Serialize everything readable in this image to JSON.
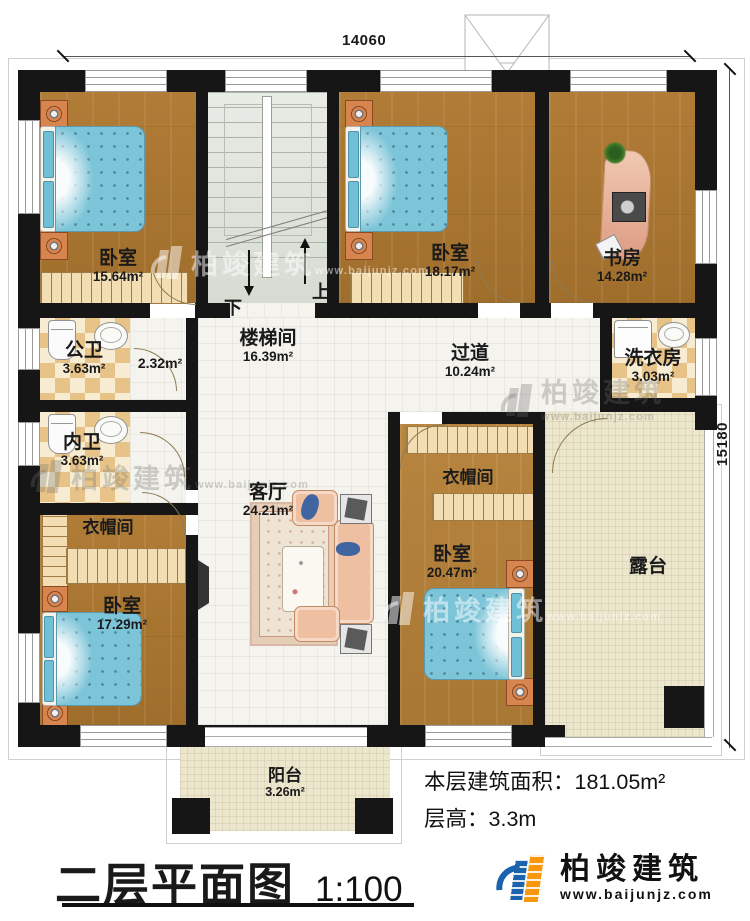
{
  "plan": {
    "dim_top": "14060",
    "dim_right": "15180",
    "rooms": {
      "bedroom_tl": {
        "name": "卧室",
        "area": "15.64m²"
      },
      "stairwell": {
        "name": "楼梯间",
        "area": "16.39m²"
      },
      "bedroom_tm": {
        "name": "卧室",
        "area": "18.17m²"
      },
      "study": {
        "name": "书房",
        "area": "14.28m²"
      },
      "public_bath": {
        "name": "公卫",
        "area": "3.63m²"
      },
      "bath_lobby": {
        "area": "2.32m²"
      },
      "private_bath": {
        "name": "内卫",
        "area": "3.63m²"
      },
      "corridor": {
        "name": "过道",
        "area": "10.24m²"
      },
      "laundry": {
        "name": "洗衣房",
        "area": "3.03m²"
      },
      "living_room": {
        "name": "客厅",
        "area": "24.21m²"
      },
      "cloakroom_left": {
        "name": "衣帽间"
      },
      "cloakroom_right": {
        "name": "衣帽间"
      },
      "bedroom_bl": {
        "name": "卧室",
        "area": "17.29m²"
      },
      "bedroom_br": {
        "name": "卧室",
        "area": "20.47m²"
      },
      "terrace": {
        "name": "露台"
      },
      "balcony": {
        "name": "阳台",
        "area": "3.26m²"
      }
    },
    "stairs": {
      "up": "上",
      "down": "下"
    }
  },
  "annotations": {
    "area_label": "本层建筑面积：",
    "area_value": "181.05m²",
    "height_label": "层高：",
    "height_value": "3.3m"
  },
  "title": {
    "text": "二层平面图",
    "scale": "1:100"
  },
  "brand": {
    "name": "柏竣建筑",
    "url": "www.baijunjz.com"
  },
  "colors": {
    "wall": "#161616",
    "wood": "#a9762f",
    "tile_light": "#f7ecd2",
    "tile_dark": "#e7c387",
    "bed_blue": "#7cc4d8",
    "stair_green": "#dfe4db",
    "terrace_beige": "#ece6cd",
    "brand_blue": "#1b63ad",
    "brand_orange": "#f6990f"
  }
}
